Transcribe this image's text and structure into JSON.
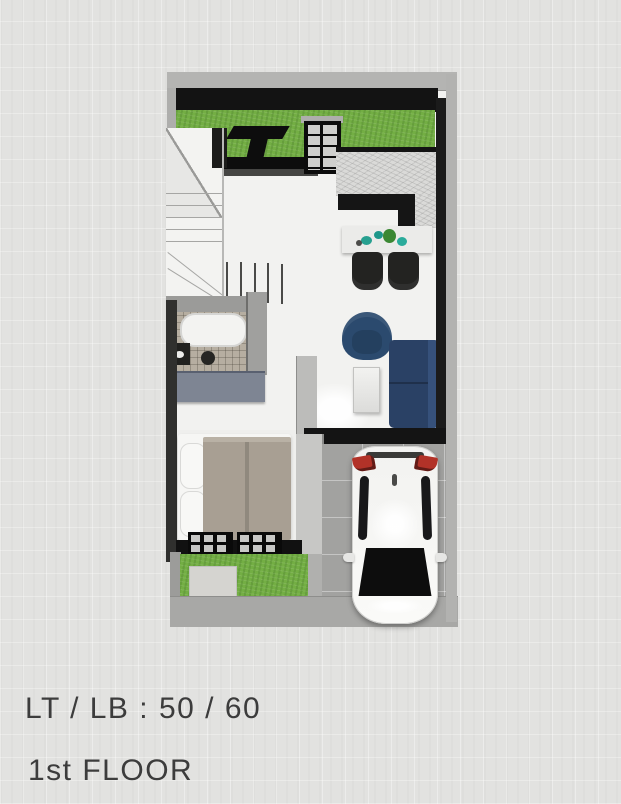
{
  "window": {
    "width": 621,
    "height": 804
  },
  "footer": {
    "area_label": "LT / LB : 50 / 60",
    "floor_label": "1st FLOOR"
  },
  "palette": {
    "background": "#e2e2e0",
    "wall_dark": "#141414",
    "wall_gray": "#b2b2b0",
    "grass_green": "#73ae44",
    "marble_counter": "#dadad8",
    "navy_furniture": "#2b4a6e",
    "bed_taupe": "#a89f93",
    "bathroom_tile": "#b6aea1",
    "carport_gray": "#a2a2a0",
    "car_white": "#f6f6f4",
    "taillight_red": "#b23228",
    "teal_decor": "#27a090",
    "text": "#3c3c3c"
  }
}
